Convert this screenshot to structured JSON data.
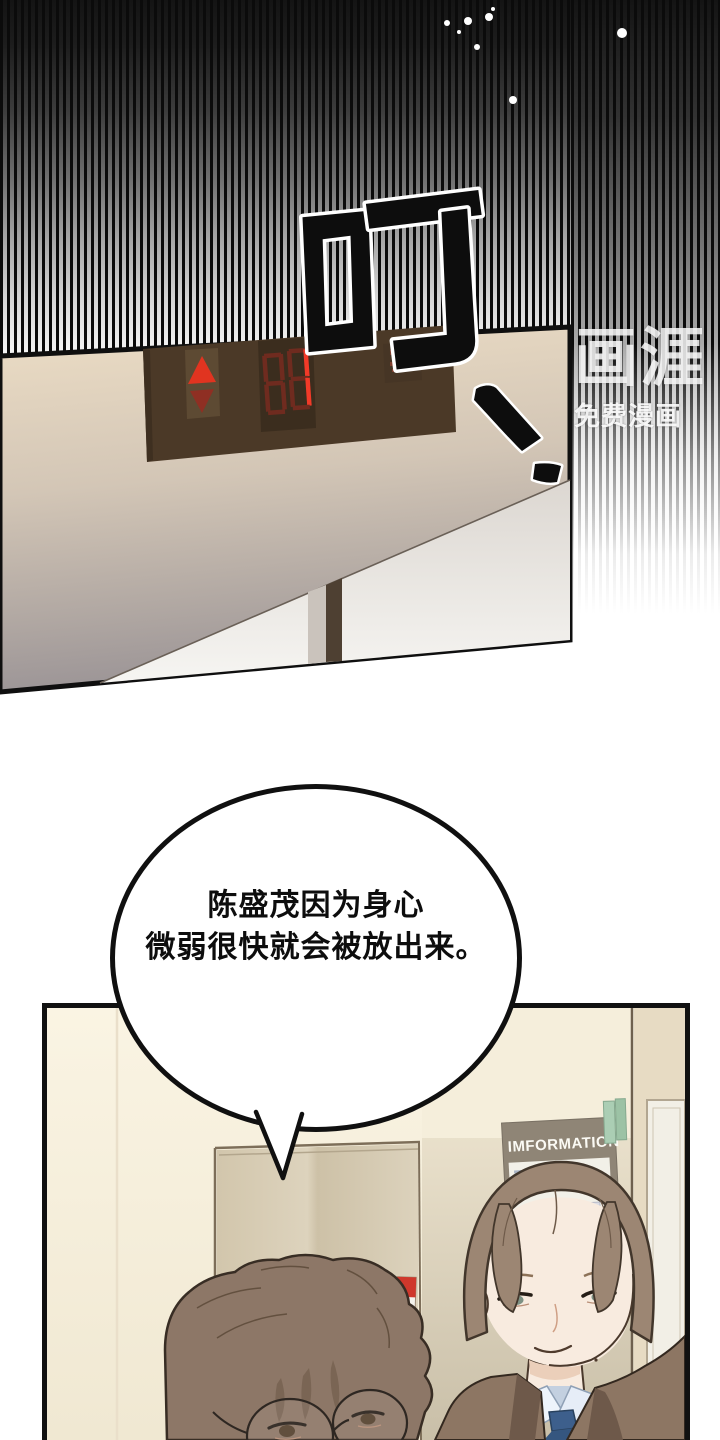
{
  "watermark": {
    "logo_text": "画涯",
    "tagline": "免费漫画"
  },
  "sfx": {
    "ding": "叮"
  },
  "panel1": {
    "elevator_display": {
      "digits": "88",
      "up_arrow": "▲",
      "down_arrow": "▼"
    }
  },
  "speech_bubble": {
    "lines": [
      "陈盛茂因为身心",
      "微弱很快就会被放出来。"
    ]
  },
  "panel2": {
    "information_sign": "IMFORMATION"
  },
  "colors": {
    "led_bright_red": "#f23a28",
    "led_dim_red": "#6f2b1f",
    "arrow_red": "#e13420",
    "arrow_dark_red": "#8f2f23",
    "elevator_panel_brown": "#4b3927",
    "wall_beige": "#ecddc5",
    "sign_board": "#8f8576",
    "sign_green": "#a7cbb0",
    "tie_blue": "#3d5f8c",
    "suit_brown": "#8d7663",
    "hair_left": "#8d7767",
    "hair_right": "#9c8673",
    "skin": "#f8ebdf",
    "outline": "#111111"
  }
}
